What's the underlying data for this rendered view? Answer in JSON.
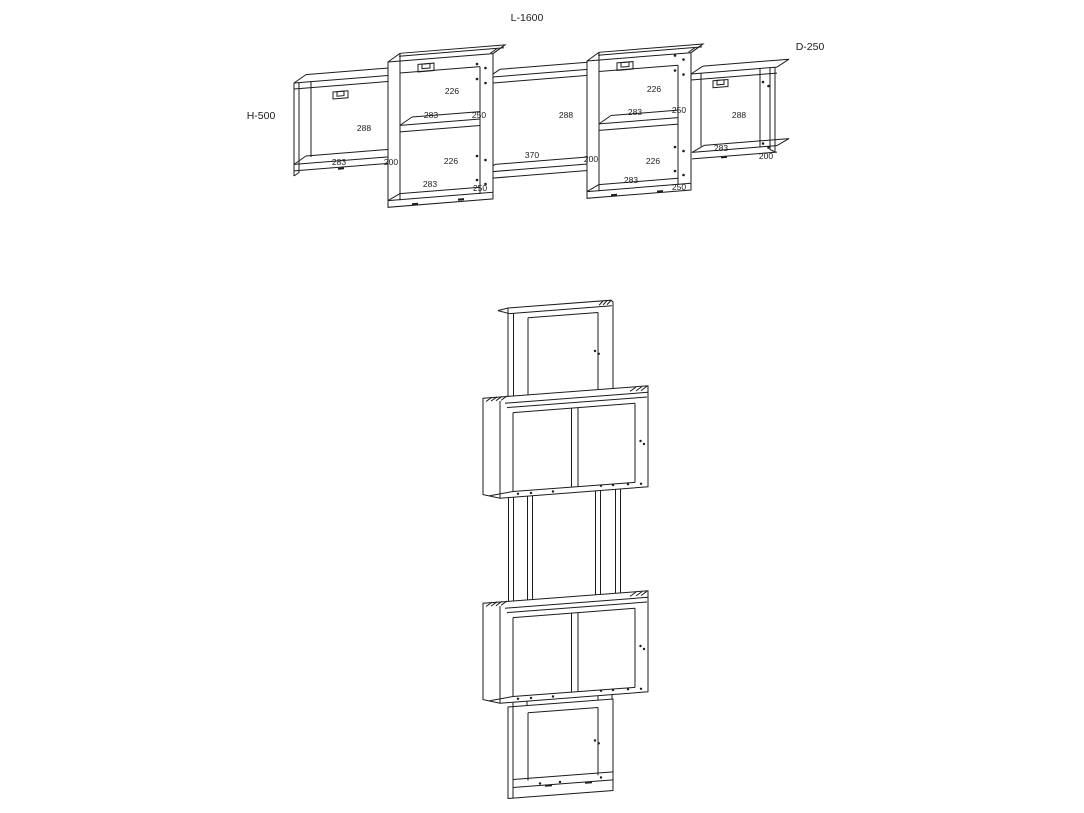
{
  "page": {
    "background": "#ffffff",
    "line_color": "#1c1c1c"
  },
  "front_view": {
    "length_label": "L-1600",
    "depth_label": "D-250",
    "height_label": "H-500",
    "left_box": {
      "opening_width": "288",
      "opening_depth": "283",
      "side_width": "200"
    },
    "left_tall_box": {
      "upper_width": "226",
      "upper_depth": "283",
      "upper_side": "250",
      "lower_width": "226",
      "lower_depth": "283",
      "lower_side": "250"
    },
    "middle_section": {
      "opening_width": "288",
      "shelf_length": "370",
      "side_width": "200"
    },
    "right_tall_box": {
      "upper_width": "226",
      "upper_depth": "283",
      "upper_side": "250",
      "lower_width": "226",
      "lower_depth": "283",
      "lower_side": "250"
    },
    "right_box": {
      "opening_width": "288",
      "opening_depth": "283",
      "side_width": "200"
    }
  }
}
